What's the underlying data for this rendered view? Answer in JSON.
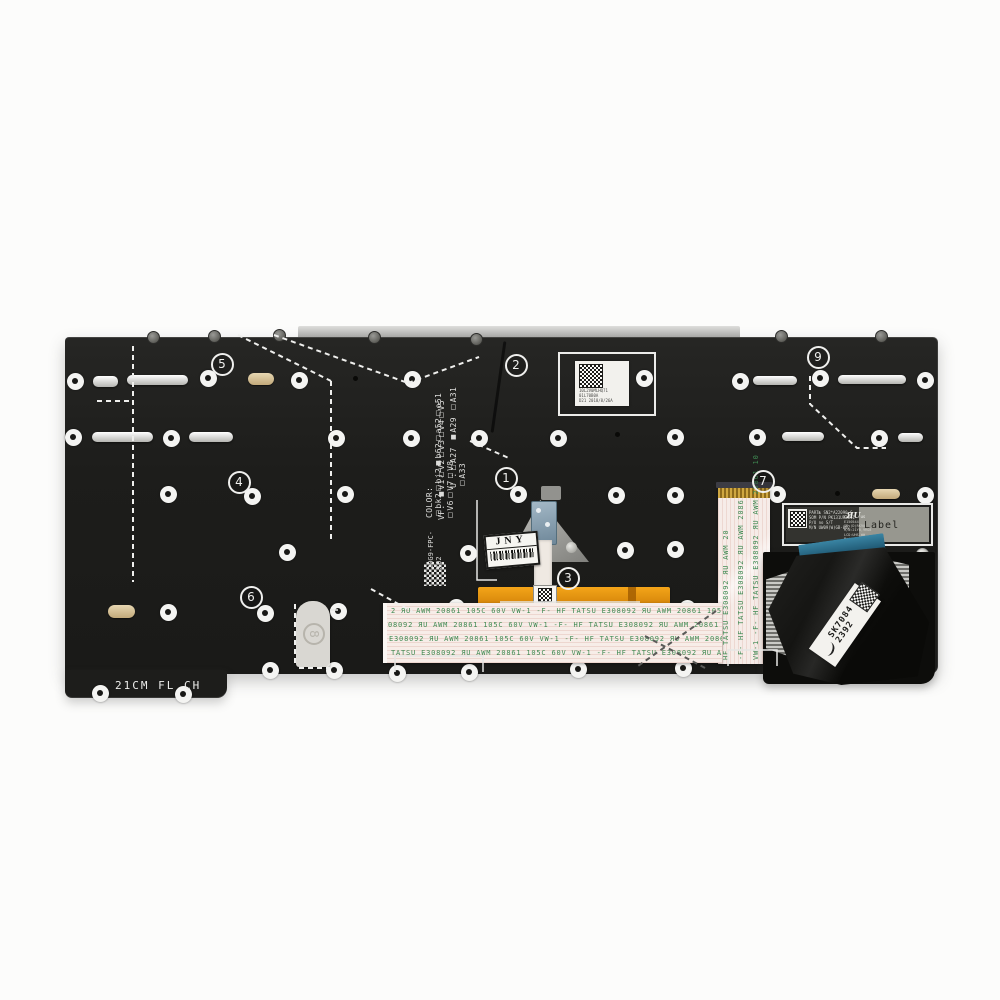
{
  "part_markings": {
    "bottom_left": "21CM FL CH",
    "fpc_code": "20G9-FPC-X02",
    "option_lines": [
      "U :□A27 ■A29 □A31 □A33",
      "VF: ■V1□V2□V3□V4□V5 □V6□V7□V8",
      "COLOR: □bk2□bj2■b62□a52□o51"
    ],
    "ver": "Ver"
  },
  "top_label": {
    "lines": [
      "10L2V0MLHQ71",
      "01L70B0A",
      "D21 2018/8/26A"
    ]
  },
  "right_label": {
    "left_lines": [
      "PART№ SN2*A22090-C",
      "SOM P/N PK131UR2B11",
      "P/U no S/T",
      "M/N UW09(W)GB-002"
    ],
    "ul_prefix": "c",
    "ul_mark": "ЯU",
    "ul_suffix": "us",
    "right_lines": [
      "E150544",
      "ID:(D)RK90",
      "M/N:21YB,9RG8",
      "LCD:UHS.WW",
      "Made in China"
    ],
    "big_text": "Label"
  },
  "jny_label": {
    "text": "JNY"
  },
  "ribbon_label": {
    "line1": "SK7084",
    "line2": "2392"
  },
  "center_label": {
    "text": "21"
  },
  "sticker8": {
    "n": "8"
  },
  "backlight_ribbon": {
    "rows": [
      "2 ЯU AWM 20861 105C 60V VW-1 -F- HF    TATSU E308092 ЯU AWM 20861 105C 60",
      "308092 ЯU AWM 20861 105C 60V VW-1 -F- HF    TATSU E308092 ЯU AWM 20861 105",
      "U E308092 ЯU AWM 20861 105C 60V VW-1 -F- HF    TATSU E308092 ЯU AWM 2086",
      "TATSU E308092 ЯU AWM 20861 105C 60V VW-1 -F- HF    TATSU E308092 ЯU AWM 2"
    ],
    "row_tops": [
      4,
      18,
      32,
      46
    ],
    "row_lefts": [
      4,
      -4,
      -8,
      4
    ]
  },
  "vertical_ribbon": {
    "columns": [
      "HF   TATSU E308092 ЯU AWM 20",
      "-F- HF   TATSU E308092 ЯU AWM 2086",
      "VW-1 -F- HF  TATSU E308092 ЯU AWM 20861 10"
    ],
    "column_lefts": [
      722,
      737,
      752
    ]
  },
  "callouts": [
    {
      "n": "1",
      "x": 506,
      "y": 478
    },
    {
      "n": "2",
      "x": 516,
      "y": 365
    },
    {
      "n": "3",
      "x": 568,
      "y": 578
    },
    {
      "n": "4",
      "x": 239,
      "y": 482
    },
    {
      "n": "5",
      "x": 222,
      "y": 364
    },
    {
      "n": "6",
      "x": 251,
      "y": 597
    },
    {
      "n": "7",
      "x": 763,
      "y": 481
    },
    {
      "n": "9",
      "x": 818,
      "y": 357
    }
  ],
  "screws": {
    "rings": [
      [
        75,
        381
      ],
      [
        208,
        378
      ],
      [
        299,
        380
      ],
      [
        412,
        379
      ],
      [
        644,
        378
      ],
      [
        740,
        381
      ],
      [
        820,
        378
      ],
      [
        925,
        380
      ],
      [
        73,
        437
      ],
      [
        171,
        438
      ],
      [
        336,
        438
      ],
      [
        411,
        438
      ],
      [
        479,
        438
      ],
      [
        558,
        438
      ],
      [
        675,
        437
      ],
      [
        757,
        437
      ],
      [
        879,
        438
      ],
      [
        168,
        494
      ],
      [
        252,
        496
      ],
      [
        345,
        494
      ],
      [
        518,
        494
      ],
      [
        616,
        495
      ],
      [
        675,
        495
      ],
      [
        777,
        494
      ],
      [
        925,
        495
      ],
      [
        287,
        552
      ],
      [
        468,
        553
      ],
      [
        625,
        550
      ],
      [
        675,
        549
      ],
      [
        168,
        612
      ],
      [
        265,
        613
      ],
      [
        338,
        611
      ],
      [
        456,
        607
      ],
      [
        573,
        606
      ],
      [
        687,
        608
      ],
      [
        270,
        670
      ],
      [
        334,
        670
      ],
      [
        397,
        673
      ],
      [
        469,
        672
      ],
      [
        578,
        669
      ],
      [
        683,
        668
      ],
      [
        100,
        693
      ],
      [
        183,
        694
      ]
    ],
    "top": [
      [
        152,
        336
      ],
      [
        213,
        335
      ],
      [
        278,
        334
      ],
      [
        373,
        336
      ],
      [
        475,
        338
      ],
      [
        780,
        335
      ],
      [
        880,
        335
      ]
    ],
    "silver": [
      [
        922,
        554
      ],
      [
        927,
        611
      ],
      [
        925,
        669
      ]
    ],
    "holes": [
      [
        355,
        378
      ],
      [
        617,
        434
      ],
      [
        837,
        493
      ]
    ],
    "grommets": [
      [
        788,
        612
      ],
      [
        882,
        612
      ]
    ]
  },
  "slots": {
    "silver": [
      [
        93,
        376,
        25,
        11
      ],
      [
        127,
        375,
        61,
        10
      ],
      [
        753,
        376,
        44,
        9
      ],
      [
        838,
        375,
        68,
        9
      ],
      [
        92,
        432,
        61,
        10
      ],
      [
        189,
        432,
        44,
        10
      ],
      [
        782,
        432,
        42,
        9
      ],
      [
        898,
        433,
        25,
        9
      ]
    ],
    "tan": [
      [
        248,
        373,
        26,
        12
      ],
      [
        872,
        489,
        28,
        10
      ],
      [
        108,
        605,
        27,
        13
      ]
    ]
  },
  "dashes": {
    "white": [
      "M133 346 V582",
      "M97 401 H131",
      "M238 335 L331 381",
      "M274 335 L408 383",
      "M331 381 V540",
      "M408 383 L479 357",
      "M810 376 V404 L857 448 H886",
      "M371 589 L413 612",
      "M470 441 L511 459",
      "M295 604 V664",
      "M299 668 H331"
    ],
    "dark": [
      "M716 611 L638 666",
      "M645 636 L707 669"
    ],
    "solid": [
      "M500 602 H640",
      "M395 672 V656 H483 V672",
      "M728 666 V650 H777 V666",
      "M477 500 V580 H497",
      "M330 610 H338"
    ]
  },
  "colors": {
    "plate": "#1d1d1b",
    "background": "#fcfcfb",
    "ribbon_bg": "#f7ede8",
    "ribbon_text": "#3f8a52",
    "kapton_orange": "#e8930c",
    "blue_stiffener": "#2a7092",
    "silk_white": "#e9e9e7"
  }
}
